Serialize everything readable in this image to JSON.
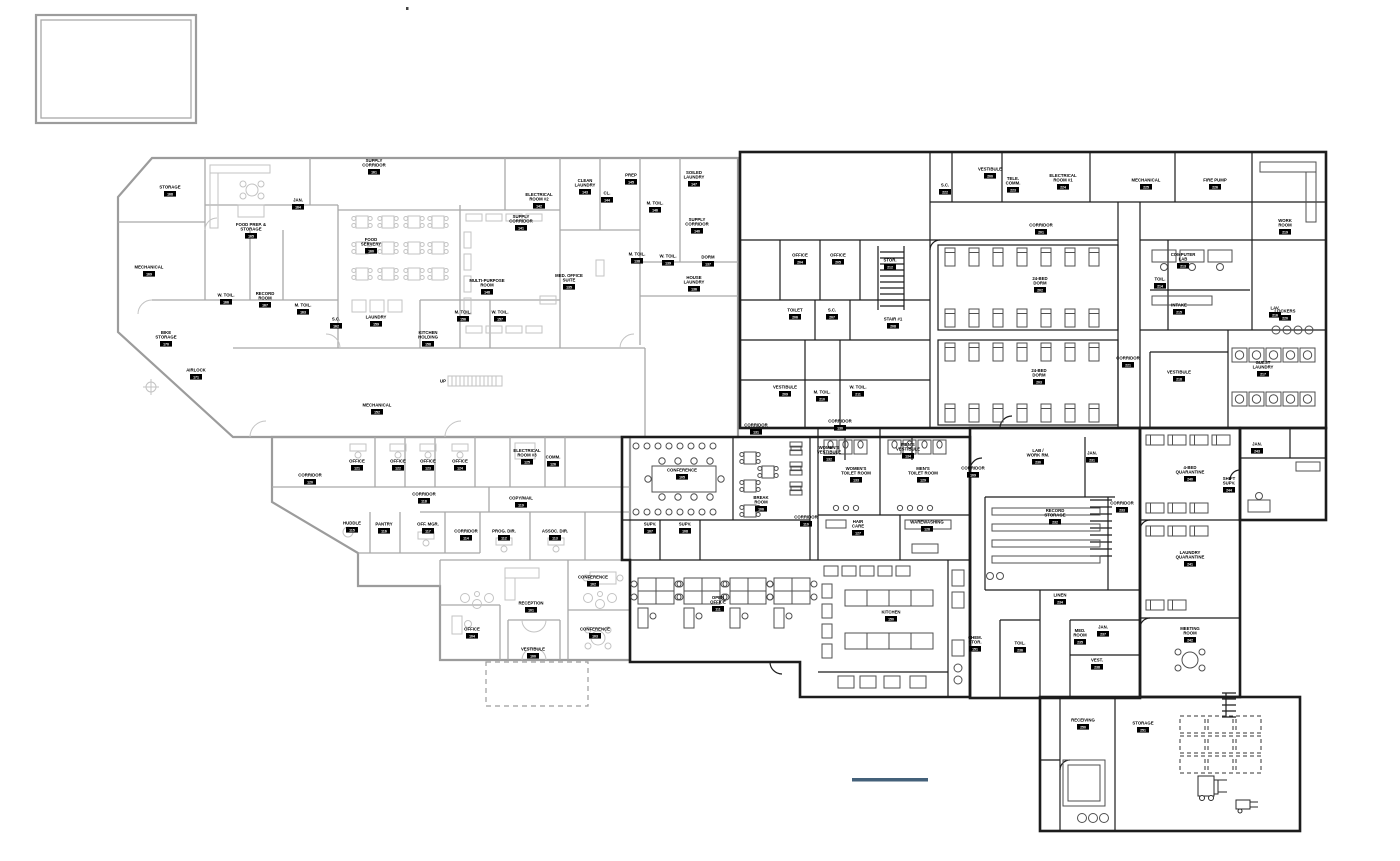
{
  "drawing": {
    "type": "architectural-floor-plan",
    "background": "#ffffff",
    "existing_wall_color": "#a9a9a9",
    "new_wall_color": "#1c1c1c",
    "scale_bar_color": "#44617a",
    "ramp_text": "UP"
  },
  "labels": [
    {
      "t": "STORAGE",
      "n": "168",
      "x": 170,
      "y": 190
    },
    {
      "t": "MECHANICAL",
      "n": "169",
      "x": 149,
      "y": 270
    },
    {
      "t": "BIKE\nSTORAGE",
      "n": "170",
      "x": 166,
      "y": 340
    },
    {
      "t": "AIRLOCK",
      "n": "171",
      "x": 196,
      "y": 373
    },
    {
      "t": "FOOD PREP. &\nSTORAGE",
      "n": "165",
      "x": 251,
      "y": 232
    },
    {
      "t": "JAN.",
      "n": "164",
      "x": 298,
      "y": 203
    },
    {
      "t": "W. TOIL.",
      "n": "166",
      "x": 226,
      "y": 298
    },
    {
      "t": "RECORD\nROOM",
      "n": "167",
      "x": 265,
      "y": 301
    },
    {
      "t": "M. TOIL.",
      "n": "163",
      "x": 303,
      "y": 308
    },
    {
      "t": "FOOD\nSERVERY",
      "n": "160",
      "x": 371,
      "y": 247
    },
    {
      "t": "SUPPLY\nCORRIDOR",
      "n": "161",
      "x": 374,
      "y": 168
    },
    {
      "t": "S.C.",
      "n": "162",
      "x": 336,
      "y": 322
    },
    {
      "t": "LAUNDRY",
      "n": "159",
      "x": 376,
      "y": 320
    },
    {
      "t": "MULTI-PURPOSE\nROOM",
      "n": "148",
      "x": 487,
      "y": 288
    },
    {
      "t": "KITCHEN\nHOLDING",
      "n": "158",
      "x": 428,
      "y": 340
    },
    {
      "t": "M. TOIL.",
      "n": "156",
      "x": 463,
      "y": 315
    },
    {
      "t": "W. TOIL.",
      "n": "157",
      "x": 500,
      "y": 315
    },
    {
      "t": "CLEAN\nLAUNDRY",
      "n": "143",
      "x": 585,
      "y": 188
    },
    {
      "t": "CL.",
      "n": "144",
      "x": 607,
      "y": 196
    },
    {
      "t": "PREP",
      "n": "145",
      "x": 631,
      "y": 178
    },
    {
      "t": "ELECTRICAL\nROOM #2",
      "n": "142",
      "x": 539,
      "y": 202
    },
    {
      "t": "SUPPLY\nCORRIDOR",
      "n": "141",
      "x": 521,
      "y": 224
    },
    {
      "t": "M. TOIL.",
      "n": "146",
      "x": 655,
      "y": 206
    },
    {
      "t": "SOILED\nLAUNDRY",
      "n": "147",
      "x": 694,
      "y": 180
    },
    {
      "t": "SUPPLY\nCORRIDOR",
      "n": "140",
      "x": 697,
      "y": 227
    },
    {
      "t": "M. TOIL.",
      "n": "138",
      "x": 637,
      "y": 257
    },
    {
      "t": "W. TOIL.",
      "n": "139",
      "x": 668,
      "y": 259
    },
    {
      "t": "DORM",
      "n": "137",
      "x": 708,
      "y": 260
    },
    {
      "t": "HOUSE\nLAUNDRY",
      "n": "136",
      "x": 694,
      "y": 285
    },
    {
      "t": "MED. OFFICE\nSUITE",
      "n": "135",
      "x": 569,
      "y": 283
    },
    {
      "t": "MECHANICAL",
      "n": "152",
      "x": 377,
      "y": 408
    },
    {
      "t": "CORRIDOR",
      "n": "120",
      "x": 310,
      "y": 478
    },
    {
      "t": "OFFICE",
      "n": "121",
      "x": 357,
      "y": 464
    },
    {
      "t": "OFFICE",
      "n": "122",
      "x": 398,
      "y": 464
    },
    {
      "t": "OFFICE",
      "n": "123",
      "x": 428,
      "y": 464
    },
    {
      "t": "OFFICE",
      "n": "124",
      "x": 460,
      "y": 464
    },
    {
      "t": "ELECTRICAL\nROOM #3",
      "n": "125",
      "x": 527,
      "y": 458
    },
    {
      "t": "COMM.",
      "n": "126",
      "x": 553,
      "y": 460
    },
    {
      "t": "COPY/MAIL",
      "n": "119",
      "x": 521,
      "y": 501
    },
    {
      "t": "CORRIDOR",
      "n": "118",
      "x": 424,
      "y": 497
    },
    {
      "t": "HUDDLE",
      "n": "115",
      "x": 352,
      "y": 526
    },
    {
      "t": "PANTRY",
      "n": "116",
      "x": 384,
      "y": 527
    },
    {
      "t": "OFF. MGR.",
      "n": "117",
      "x": 428,
      "y": 527
    },
    {
      "t": "CORRIDOR",
      "n": "114",
      "x": 466,
      "y": 534
    },
    {
      "t": "PROG. DIR.",
      "n": "112",
      "x": 504,
      "y": 534
    },
    {
      "t": "ASSOC. DIR.",
      "n": "113",
      "x": 555,
      "y": 534
    },
    {
      "t": "RECEPTION",
      "n": "101",
      "x": 531,
      "y": 606
    },
    {
      "t": "OFFICE",
      "n": "104",
      "x": 472,
      "y": 632
    },
    {
      "t": "CONFERENCE",
      "n": "102",
      "x": 593,
      "y": 580
    },
    {
      "t": "CONFERENCE",
      "n": "103",
      "x": 595,
      "y": 632
    },
    {
      "t": "VESTIBULE",
      "n": "100",
      "x": 533,
      "y": 652
    },
    {
      "t": "CONFERENCE",
      "n": "105",
      "x": 682,
      "y": 473
    },
    {
      "t": "BREAK\nROOM",
      "n": "106",
      "x": 761,
      "y": 505
    },
    {
      "t": "SUPV.",
      "n": "107",
      "x": 650,
      "y": 527
    },
    {
      "t": "SUPV.",
      "n": "108",
      "x": 685,
      "y": 527
    },
    {
      "t": "CORRIDOR",
      "n": "110",
      "x": 806,
      "y": 520
    },
    {
      "t": "OPEN\nOFFICE",
      "n": "111",
      "x": 718,
      "y": 605
    },
    {
      "t": "CORRIDOR",
      "n": "131",
      "x": 756,
      "y": 428
    },
    {
      "t": "CORRIDOR",
      "n": "130",
      "x": 840,
      "y": 424
    },
    {
      "t": "WOMEN'S\nVESTIBULE",
      "n": "132",
      "x": 829,
      "y": 455
    },
    {
      "t": "WOMEN'S\nTOILET ROOM",
      "n": "133",
      "x": 856,
      "y": 476
    },
    {
      "t": "MEN'S\nVESTIBULE",
      "n": "134",
      "x": 908,
      "y": 452
    },
    {
      "t": "MEN'S\nTOILET ROOM",
      "n": "129",
      "x": 923,
      "y": 476
    },
    {
      "t": "HAIR\nCARE",
      "n": "127",
      "x": 858,
      "y": 529
    },
    {
      "t": "WAREWASHING",
      "n": "128",
      "x": 927,
      "y": 525
    },
    {
      "t": "CORRIDOR",
      "n": "109",
      "x": 973,
      "y": 471
    },
    {
      "t": "KITCHEN",
      "n": "150",
      "x": 891,
      "y": 615
    },
    {
      "t": "CHEM.\nSTOR.",
      "n": "151",
      "x": 975,
      "y": 645
    },
    {
      "t": "S.C.",
      "n": "222",
      "x": 945,
      "y": 188
    },
    {
      "t": "VESTIBULE",
      "n": "200",
      "x": 990,
      "y": 172
    },
    {
      "t": "TELE.\nCOMM.",
      "n": "223",
      "x": 1013,
      "y": 186
    },
    {
      "t": "ELECTRICAL\nROOM #1",
      "n": "224",
      "x": 1063,
      "y": 183
    },
    {
      "t": "MECHANICAL",
      "n": "225",
      "x": 1146,
      "y": 183
    },
    {
      "t": "FIRE PUMP",
      "n": "226",
      "x": 1215,
      "y": 183
    },
    {
      "t": "CORRIDOR",
      "n": "201",
      "x": 1041,
      "y": 228
    },
    {
      "t": "24-BED\nDORM",
      "n": "202",
      "x": 1040,
      "y": 286
    },
    {
      "t": "24-BED\nDORM",
      "n": "203",
      "x": 1039,
      "y": 378
    },
    {
      "t": "OFFICE",
      "n": "204",
      "x": 800,
      "y": 258
    },
    {
      "t": "OFFICE",
      "n": "205",
      "x": 838,
      "y": 258
    },
    {
      "t": "TOILET",
      "n": "206",
      "x": 795,
      "y": 313
    },
    {
      "t": "S.C.",
      "n": "207",
      "x": 832,
      "y": 313
    },
    {
      "t": "STAIR #1",
      "n": "208",
      "x": 893,
      "y": 322
    },
    {
      "t": "VESTIBULE",
      "n": "209",
      "x": 785,
      "y": 390
    },
    {
      "t": "M. TOIL.",
      "n": "210",
      "x": 822,
      "y": 395
    },
    {
      "t": "W. TOIL.",
      "n": "211",
      "x": 858,
      "y": 390
    },
    {
      "t": "STOR.",
      "n": "212",
      "x": 890,
      "y": 263
    },
    {
      "t": "COMPUTER\nLAB",
      "n": "213",
      "x": 1183,
      "y": 262
    },
    {
      "t": "TOIL.",
      "n": "214",
      "x": 1160,
      "y": 282
    },
    {
      "t": "INTAKE",
      "n": "215",
      "x": 1179,
      "y": 308
    },
    {
      "t": "LAV.",
      "n": "216",
      "x": 1275,
      "y": 311
    },
    {
      "t": "GUEST\nLAUNDRY",
      "n": "217",
      "x": 1263,
      "y": 370
    },
    {
      "t": "VESTIBULE",
      "n": "218",
      "x": 1179,
      "y": 375
    },
    {
      "t": "WORK\nROOM",
      "n": "219",
      "x": 1285,
      "y": 228
    },
    {
      "t": "LOCKERS",
      "n": "220",
      "x": 1285,
      "y": 314
    },
    {
      "t": "CORRIDOR",
      "n": "221",
      "x": 1128,
      "y": 361
    },
    {
      "t": "LAB /\nWORK RM.",
      "n": "230",
      "x": 1038,
      "y": 458
    },
    {
      "t": "JAN.",
      "n": "231",
      "x": 1092,
      "y": 456
    },
    {
      "t": "RECORD\nSTORAGE",
      "n": "232",
      "x": 1055,
      "y": 518
    },
    {
      "t": "CORRIDOR",
      "n": "233",
      "x": 1122,
      "y": 506
    },
    {
      "t": "LINEN",
      "n": "234",
      "x": 1060,
      "y": 598
    },
    {
      "t": "MED.\nROOM",
      "n": "235",
      "x": 1080,
      "y": 638
    },
    {
      "t": "TOIL.",
      "n": "236",
      "x": 1020,
      "y": 646
    },
    {
      "t": "JAN.",
      "n": "237",
      "x": 1103,
      "y": 630
    },
    {
      "t": "VEST.",
      "n": "238",
      "x": 1097,
      "y": 663
    },
    {
      "t": "4-BED\nQUARANTINE",
      "n": "240",
      "x": 1190,
      "y": 475
    },
    {
      "t": "LAUNDRY\nQUARANTINE",
      "n": "241",
      "x": 1190,
      "y": 560
    },
    {
      "t": "MEETING\nROOM",
      "n": "242",
      "x": 1190,
      "y": 636
    },
    {
      "t": "JAN.",
      "n": "243",
      "x": 1257,
      "y": 447
    },
    {
      "t": "SHIFT\nSUPV.",
      "n": "244",
      "x": 1229,
      "y": 486
    },
    {
      "t": "RECEIVING",
      "n": "250",
      "x": 1083,
      "y": 723
    },
    {
      "t": "STORAGE",
      "n": "251",
      "x": 1143,
      "y": 726
    },
    {
      "t": "UP",
      "n": "",
      "x": 443,
      "y": 384
    }
  ]
}
